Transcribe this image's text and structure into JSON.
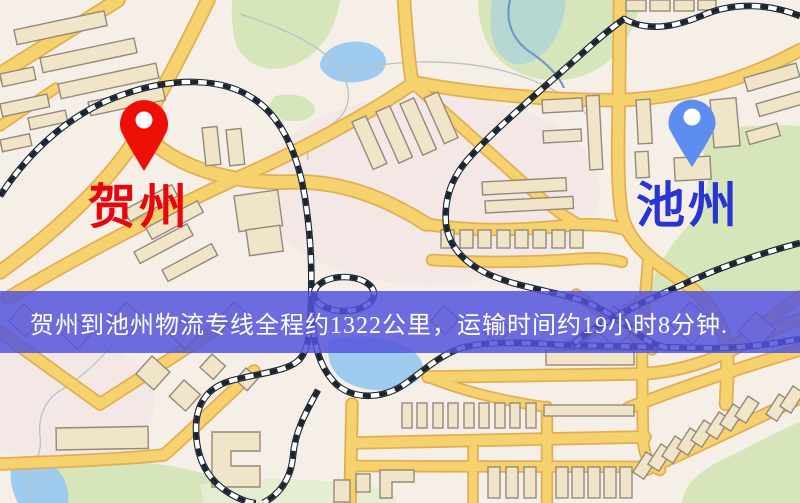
{
  "map": {
    "origin": {
      "name": "贺州",
      "pin_icon": "red-location-pin"
    },
    "destination": {
      "name": "池州",
      "pin_icon": "blue-location-pin"
    },
    "banner": {
      "text": "贺州到池州物流专线全程约1322公里，运输时间约19小时8分钟."
    }
  },
  "route_summary": {
    "origin": "贺州",
    "destination": "池州",
    "service": "物流专线",
    "distance_text": "约1322公里",
    "duration_text": "约19小时8分钟"
  },
  "theme": {
    "map-bg": "#f6efe7",
    "map-wash": "#f2e2e8",
    "road-fill": "#f6d26e",
    "road-edge": "#e2ae53",
    "building-fill": "#f0e5c8",
    "building-stroke": "#94897a",
    "park": "#d7e6ba",
    "park-light": "#e6eed2",
    "water": "#9fccee",
    "water-teal": "#b7d8d2",
    "stream": "#6f97c8",
    "contour": "#b9c2c4",
    "rail-dark": "#1b2430",
    "rail-light": "#ffffff",
    "banner-bg": "rgba(82,82,221,0.84)",
    "banner-text": "#ffffff",
    "origin-color": "#ee1007",
    "origin-label-color": "#e8050c",
    "dest-color": "#5d8df0",
    "dest-label-color": "#2935d2",
    "pin-hole": "#ffffff"
  }
}
